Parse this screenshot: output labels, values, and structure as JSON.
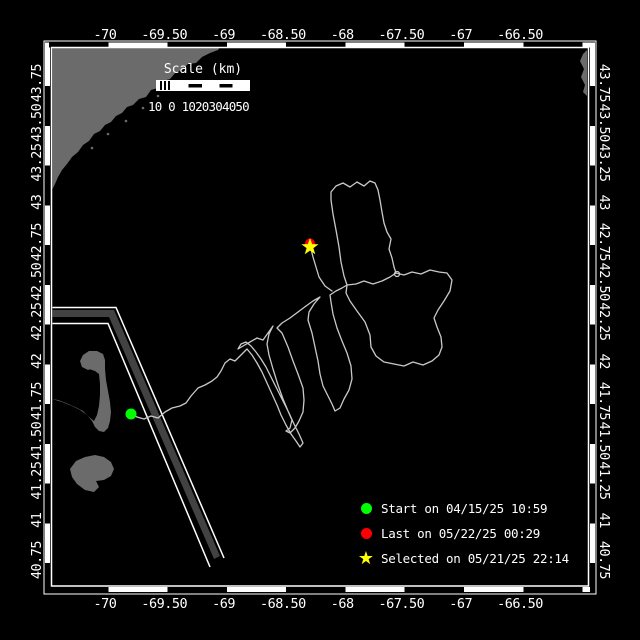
{
  "map": {
    "scale_bar": {
      "title": "Scale (km)",
      "tick_text": "10 0 1020304050",
      "ticks": [
        "10",
        "0",
        "10",
        "20",
        "30",
        "40",
        "50"
      ]
    },
    "axes": {
      "lon_tick_labels": [
        "-70",
        "-69.50",
        "-69",
        "-68.50",
        "-68",
        "-67.50",
        "-67",
        "-66.50"
      ],
      "lat_tick_labels": [
        "40.75",
        "41",
        "41.25",
        "41.50",
        "41.75",
        "42",
        "42.25",
        "42.50",
        "42.75",
        "43",
        "43.25",
        "43.50",
        "43.75"
      ]
    },
    "legend": {
      "items": [
        {
          "marker": "dot",
          "color": "#00ff00",
          "label": "Start on 04/15/25 10:59"
        },
        {
          "marker": "dot",
          "color": "#ff0000",
          "label": "Last on 05/22/25 00:29"
        },
        {
          "marker": "star",
          "color": "#ffff00",
          "label": "Selected on 05/21/25 22:14"
        }
      ]
    },
    "colors": {
      "background": "#000000",
      "frame": "#ffffff",
      "land": "#6b6b6b",
      "track": "#c9c9c9",
      "lane_fill": "#424242",
      "start": "#00ff00",
      "last": "#ff0000",
      "selected": "#ffff00",
      "text": "#ffffff"
    }
  }
}
